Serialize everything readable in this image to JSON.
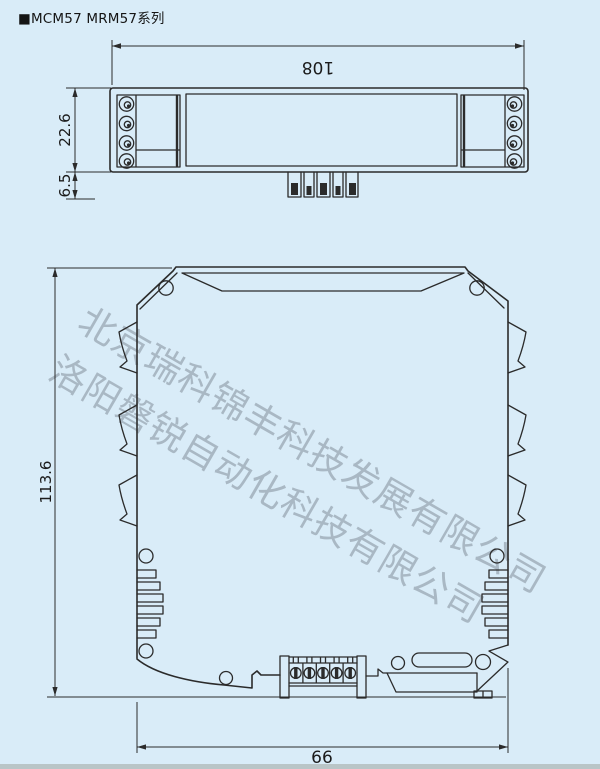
{
  "page": {
    "title": "■MCM57 MRM57系列",
    "colors": {
      "background": "#d9ecf8",
      "line": "#2b2b2b",
      "watermark_gray": "#8a96a0"
    }
  },
  "watermark": {
    "line1": "北京瑞科锦丰科技发展有限公司",
    "line2": "洛阳磐锐自动化科技有限公司"
  },
  "top_view": {
    "width_mm": "108",
    "body_height_mm": "22.6",
    "pin_height_mm": "6.5"
  },
  "front_view": {
    "height_mm": "113.6",
    "width_mm": "66"
  }
}
